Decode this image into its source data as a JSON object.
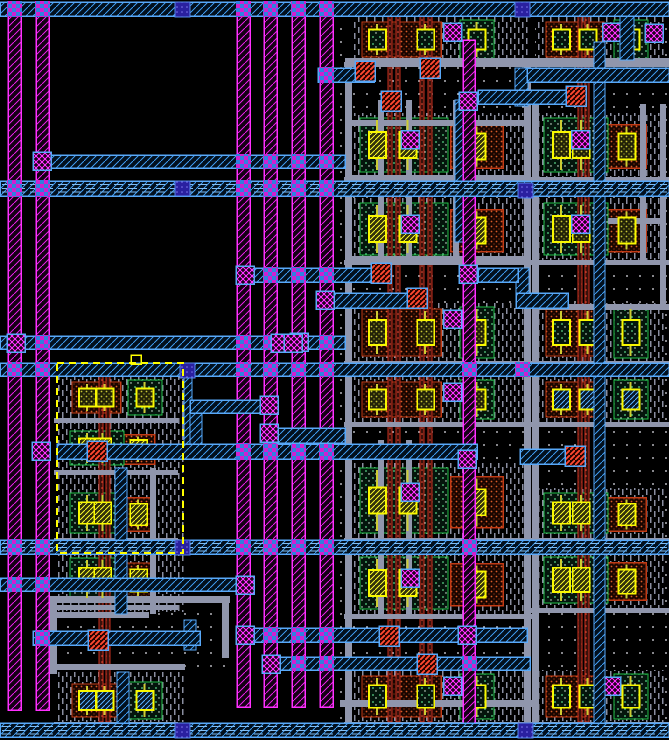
{
  "view": {
    "description": "ic-layout-editor-canvas",
    "width": 669,
    "height": 740,
    "colors": {
      "background": "#000000",
      "metal1_magenta": "#FF30FF",
      "metal2_cyan": "#58A8F8",
      "via_blue": "#2A20A0",
      "contact_yellow": "#F8F800",
      "diffusion_green": "#20C048",
      "pdiff_orange": "#C23A14",
      "poly_red": "#F05038",
      "metal_gray": "#9096AC",
      "selection_yellow": "#FFFF00"
    }
  },
  "layout": {
    "dots_areas": [
      [
        340,
        16,
        329,
        710
      ],
      [
        50,
        603,
        180,
        70
      ]
    ],
    "dash_areas": [
      [
        57,
        376,
        128,
        236
      ],
      [
        57,
        672,
        128,
        50
      ]
    ],
    "rails": [
      [
        8,
        16,
        13,
        694
      ],
      [
        36,
        16,
        13,
        694
      ],
      [
        237,
        16,
        13,
        691
      ],
      [
        264,
        16,
        13,
        691
      ],
      [
        292,
        16,
        13,
        691
      ],
      [
        320,
        16,
        13,
        691
      ],
      [
        463,
        40,
        12,
        683
      ]
    ],
    "poly_v": [
      [
        388,
        16,
        4,
        706
      ],
      [
        396,
        16,
        4,
        706
      ],
      [
        420,
        16,
        4,
        706
      ],
      [
        428,
        16,
        4,
        706
      ],
      [
        578,
        16,
        4,
        706
      ],
      [
        585,
        16,
        4,
        706
      ],
      [
        99,
        376,
        4,
        346
      ],
      [
        106,
        376,
        4,
        346
      ]
    ],
    "gray_h": [
      [
        345,
        58,
        324,
        6
      ],
      [
        345,
        120,
        186,
        6
      ],
      [
        345,
        175,
        186,
        6
      ],
      [
        345,
        256,
        186,
        6
      ],
      [
        533,
        304,
        136,
        6
      ],
      [
        340,
        700,
        192,
        7
      ],
      [
        50,
        596,
        180,
        7
      ],
      [
        57,
        612,
        92,
        6
      ],
      [
        57,
        664,
        128,
        6
      ],
      [
        608,
        218,
        56,
        6
      ]
    ],
    "gray_v": [
      [
        345,
        58,
        7,
        664
      ],
      [
        524,
        58,
        7,
        664
      ],
      [
        532,
        100,
        7,
        622
      ],
      [
        378,
        100,
        6,
        162
      ],
      [
        406,
        100,
        6,
        162
      ],
      [
        453,
        100,
        6,
        162
      ],
      [
        378,
        440,
        6,
        178
      ],
      [
        406,
        440,
        6,
        178
      ],
      [
        640,
        104,
        6,
        158
      ],
      [
        660,
        104,
        6,
        200
      ],
      [
        50,
        596,
        7,
        78
      ],
      [
        222,
        596,
        7,
        62
      ],
      [
        150,
        468,
        6,
        86
      ],
      [
        150,
        554,
        6,
        60
      ]
    ],
    "gray_dark": [
      [
        533,
        68,
        136,
        5
      ]
    ],
    "rows": [
      {
        "r": [
          352,
          18,
          176,
          44
        ],
        "flip": false,
        "fill": "greenDots",
        "via": true,
        "padr": 34
      },
      {
        "r": [
          536,
          18,
          128,
          44
        ],
        "flip": false,
        "fill": "greenDots",
        "via": true,
        "padr": 16
      },
      {
        "r": [
          352,
          115,
          176,
          62
        ],
        "flip": true,
        "fill": "yellowHatch",
        "via": true
      },
      {
        "r": [
          352,
          200,
          176,
          60
        ],
        "flip": true,
        "fill": "yellowHatch",
        "via": true
      },
      {
        "r": [
          536,
          115,
          128,
          62
        ],
        "flip": true,
        "fill": "olive",
        "via": true
      },
      {
        "r": [
          536,
          200,
          128,
          60
        ],
        "flip": true,
        "fill": "olive",
        "via": true
      },
      {
        "r": [
          352,
          305,
          176,
          56
        ],
        "flip": false,
        "fill": "olive",
        "via": true,
        "padr": 34
      },
      {
        "r": [
          352,
          378,
          176,
          44
        ],
        "flip": false,
        "fill": "olive",
        "via": true,
        "padr": 34
      },
      {
        "r": [
          536,
          305,
          128,
          56
        ],
        "flip": false,
        "fill": "greenDots",
        "via": false,
        "padr": 16
      },
      {
        "r": [
          536,
          378,
          128,
          44
        ],
        "flip": false,
        "fill": "blueHatch",
        "via": false,
        "padr": 16
      },
      {
        "r": [
          352,
          465,
          176,
          73
        ],
        "flip": true,
        "fill": "yellowHatch",
        "via": true
      },
      {
        "r": [
          352,
          554,
          176,
          60
        ],
        "flip": true,
        "fill": "yellowHatch",
        "via": true
      },
      {
        "r": [
          536,
          490,
          128,
          48
        ],
        "flip": true,
        "fill": "yellowHatch",
        "via": false
      },
      {
        "r": [
          536,
          554,
          128,
          54
        ],
        "flip": true,
        "fill": "yellowHatch",
        "via": false
      },
      {
        "r": [
          352,
          672,
          176,
          50
        ],
        "flip": false,
        "fill": "greenDots",
        "via": true,
        "padr": 34
      },
      {
        "r": [
          536,
          672,
          128,
          50
        ],
        "flip": false,
        "fill": "greenDots",
        "via": true,
        "padr": 16
      },
      {
        "r": [
          62,
          378,
          108,
          40
        ],
        "flip": false,
        "fill": "olive",
        "via": false,
        "padr": 8
      },
      {
        "r": [
          62,
          428,
          108,
          42
        ],
        "flip": true,
        "fill": "yellowHatch",
        "via": false
      },
      {
        "r": [
          62,
          490,
          108,
          48
        ],
        "flip": true,
        "fill": "yellowHatch",
        "via": false
      },
      {
        "r": [
          62,
          555,
          108,
          50
        ],
        "flip": true,
        "fill": "yellowHatch",
        "via": false
      },
      {
        "r": [
          62,
          680,
          108,
          42
        ],
        "flip": false,
        "fill": "blueHatch",
        "via": false,
        "padr": 8
      }
    ],
    "cyan_v": [
      [
        515,
        68,
        13,
        38
      ],
      [
        516,
        268,
        13,
        40
      ],
      [
        620,
        16,
        14,
        44
      ],
      [
        594,
        42,
        11,
        681
      ],
      [
        115,
        468,
        12,
        74
      ],
      [
        115,
        552,
        12,
        62
      ],
      [
        117,
        672,
        12,
        51
      ],
      [
        184,
        374,
        8,
        74
      ],
      [
        190,
        400,
        12,
        52
      ],
      [
        184,
        620,
        12,
        30
      ],
      [
        455,
        100,
        11,
        142
      ]
    ],
    "bands": [
      {
        "r": [
          0,
          2,
          669,
          14
        ],
        "rails": [
          8,
          36,
          237,
          264,
          292,
          320
        ],
        "inner": false
      },
      {
        "r": [
          33,
          155,
          312,
          13
        ],
        "rails": [
          237,
          264,
          292,
          320
        ],
        "inner": false
      },
      {
        "r": [
          0,
          181,
          669,
          15
        ],
        "rails": [
          8,
          36,
          237,
          264,
          292,
          320
        ],
        "inner": true
      },
      {
        "r": [
          318,
          68,
          56,
          14
        ],
        "rails": [
          320
        ],
        "inner": false
      },
      {
        "r": [
          527,
          68,
          142,
          14
        ],
        "rails": [],
        "inner": false
      },
      {
        "r": [
          478,
          90,
          90,
          14
        ],
        "rails": [],
        "inner": false
      },
      {
        "r": [
          236,
          268,
          136,
          14
        ],
        "rails": [
          264,
          292,
          320
        ],
        "inner": false
      },
      {
        "r": [
          318,
          293,
          92,
          15
        ],
        "rails": [
          320
        ],
        "inner": false
      },
      {
        "r": [
          478,
          268,
          40,
          14
        ],
        "rails": [],
        "inner": false
      },
      {
        "r": [
          516,
          293,
          52,
          15
        ],
        "rails": [],
        "inner": false
      },
      {
        "r": [
          0,
          336,
          345,
          13
        ],
        "rails": [
          36,
          237,
          264,
          292,
          320
        ],
        "inner": false
      },
      {
        "r": [
          0,
          363,
          669,
          13
        ],
        "rails": [
          8,
          36,
          237,
          264,
          292,
          320,
          463,
          516
        ],
        "inner": false
      },
      {
        "r": [
          57,
          444,
          420,
          15
        ],
        "rails": [
          237,
          264,
          292,
          320
        ],
        "inner": false
      },
      {
        "r": [
          277,
          428,
          68,
          15
        ],
        "rails": [],
        "inner": false
      },
      {
        "r": [
          190,
          400,
          74,
          13
        ],
        "rails": [],
        "inner": false
      },
      {
        "r": [
          520,
          449,
          46,
          15
        ],
        "rails": [],
        "inner": false
      },
      {
        "r": [
          0,
          540,
          669,
          14
        ],
        "rails": [
          8,
          36,
          237,
          264,
          292,
          320,
          463
        ],
        "inner": true
      },
      {
        "r": [
          0,
          578,
          251,
          13
        ],
        "rails": [
          8,
          36
        ],
        "inner": false
      },
      {
        "r": [
          33,
          631,
          167,
          14
        ],
        "rails": [
          36
        ],
        "inner": false
      },
      {
        "r": [
          237,
          628,
          290,
          14
        ],
        "rails": [
          264,
          292,
          320,
          463
        ],
        "inner": false
      },
      {
        "r": [
          264,
          657,
          266,
          13
        ],
        "rails": [
          292,
          320,
          463
        ],
        "inner": false
      },
      {
        "r": [
          0,
          723,
          669,
          14
        ],
        "rails": [],
        "inner": true
      }
    ],
    "vias_b": [
      [
        175,
        2
      ],
      [
        515,
        2
      ],
      [
        175,
        181
      ],
      [
        518,
        183
      ],
      [
        180,
        363
      ],
      [
        175,
        540
      ],
      [
        175,
        723
      ],
      [
        518,
        723
      ]
    ],
    "vias_m": [
      [
        33,
        152
      ],
      [
        32,
        442
      ],
      [
        260,
        396
      ],
      [
        260,
        424
      ],
      [
        236,
        266
      ],
      [
        290,
        333
      ],
      [
        316,
        291
      ],
      [
        236,
        576
      ],
      [
        236,
        626
      ],
      [
        262,
        655
      ],
      [
        459,
        92
      ],
      [
        459,
        265
      ],
      [
        458,
        450
      ],
      [
        458,
        626
      ],
      [
        271,
        334
      ],
      [
        284,
        334
      ],
      [
        7,
        334
      ],
      [
        645,
        24
      ]
    ],
    "contacts_r": [
      [
        355,
        61
      ],
      [
        381,
        91
      ],
      [
        420,
        58
      ],
      [
        566,
        86
      ],
      [
        371,
        263
      ],
      [
        407,
        288
      ],
      [
        565,
        446
      ],
      [
        379,
        626
      ],
      [
        417,
        654
      ],
      [
        87,
        441
      ],
      [
        88,
        630
      ]
    ],
    "selection": {
      "rect": [
        57,
        363,
        126,
        190
      ],
      "handle": [
        131,
        355,
        10,
        9
      ]
    }
  }
}
